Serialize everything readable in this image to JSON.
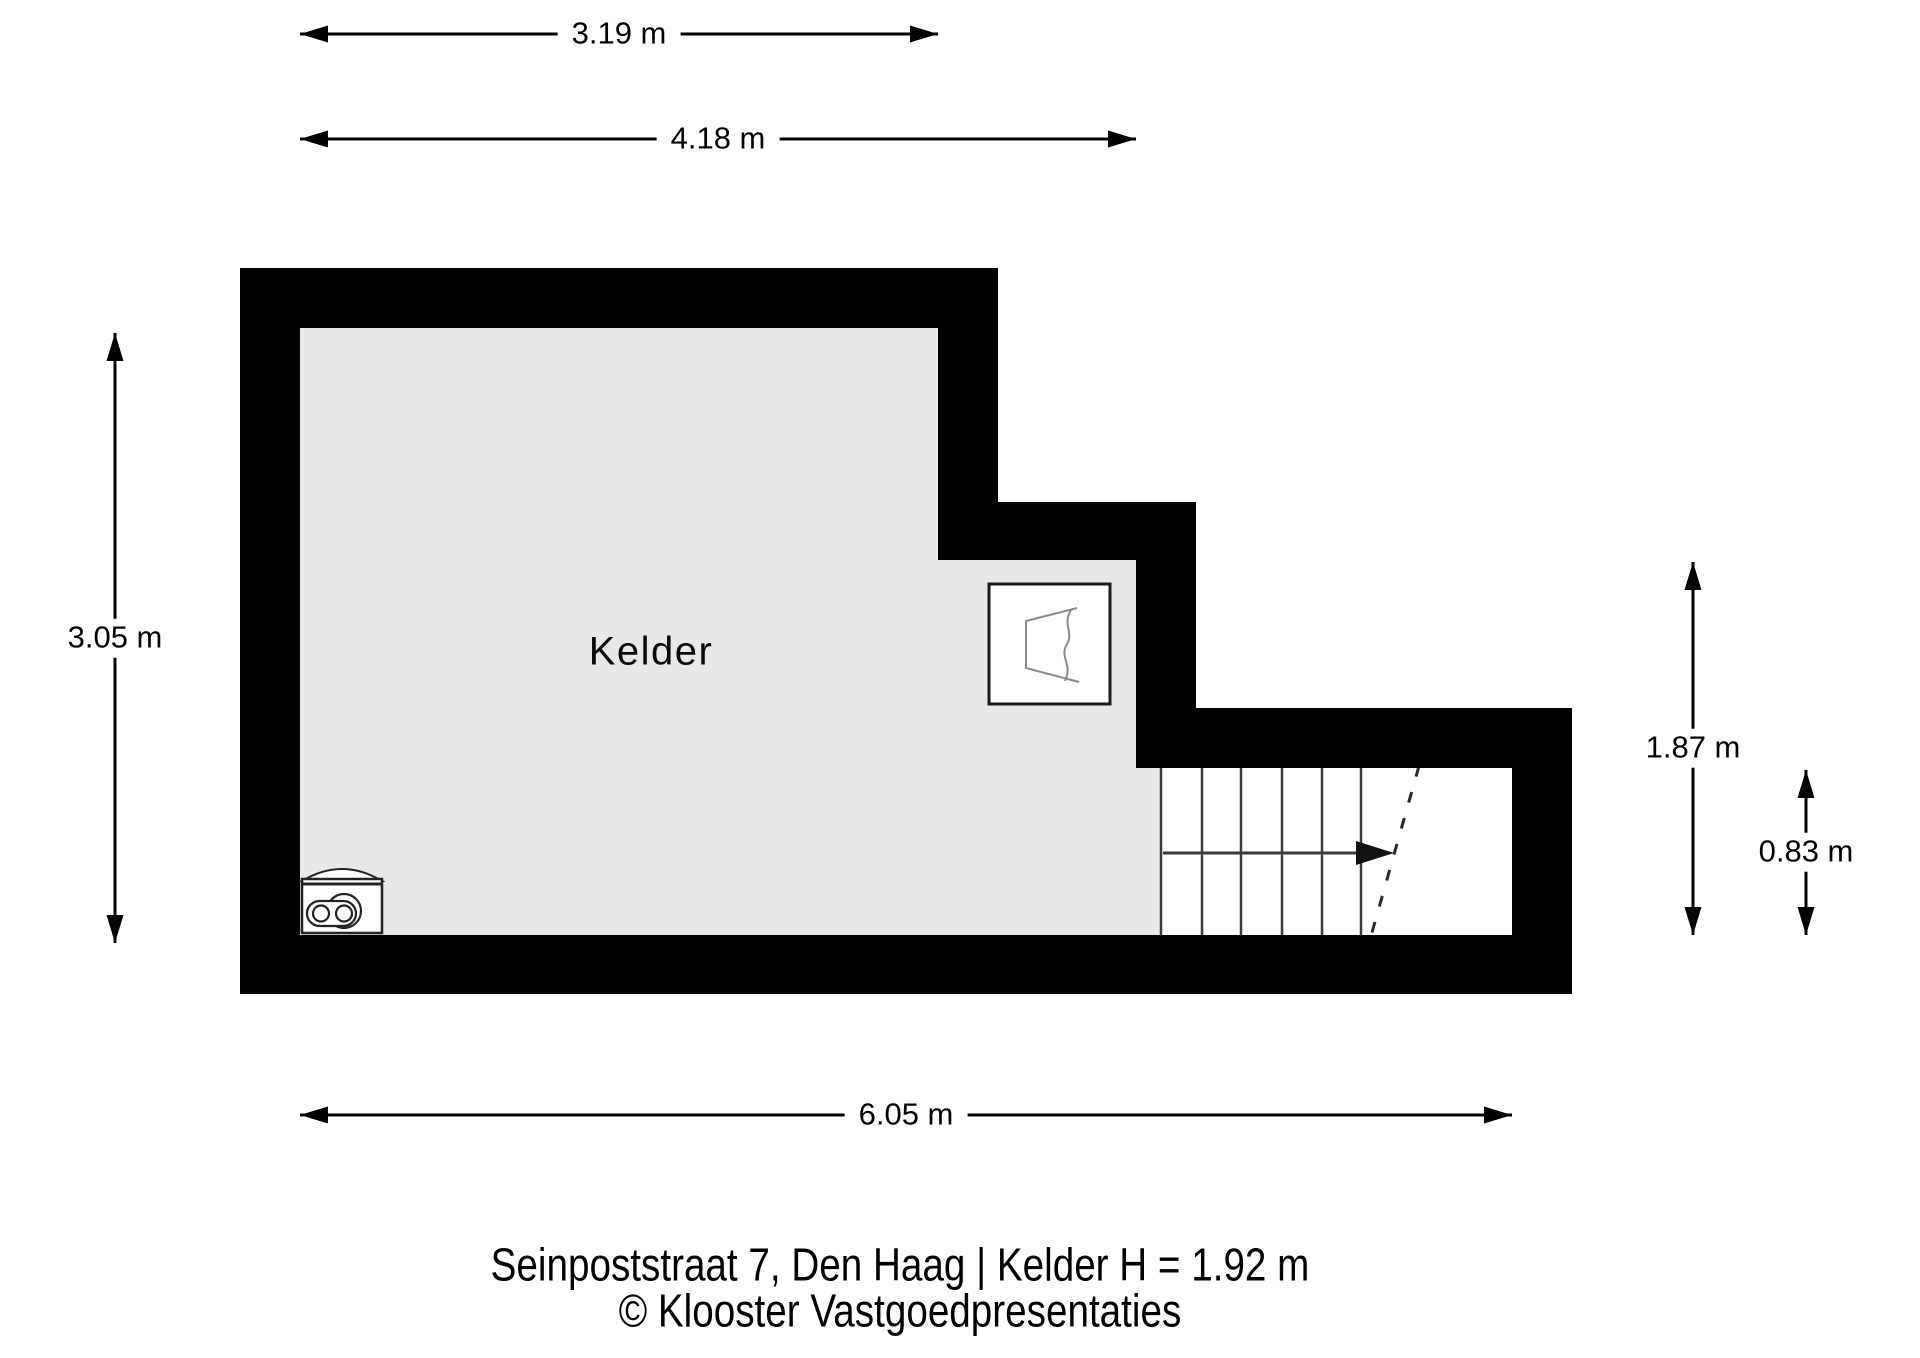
{
  "floorplan": {
    "room_label": "Kelder",
    "dimensions": {
      "top_partial": "3.19 m",
      "top_full": "4.18 m",
      "left_height": "3.05 m",
      "right_height": "1.87 m",
      "stairs_height": "0.83 m",
      "bottom_width": "6.05 m"
    },
    "colors": {
      "wall": "#000000",
      "room_fill": "#e8e8e8",
      "stairs_fill": "#ffffff",
      "dimension_line": "#000000",
      "symbol_stroke": "#8a8a8a",
      "background": "#ffffff"
    }
  },
  "caption": {
    "address": "Seinpoststraat 7, Den Haag | Kelder H = 1.92 m",
    "credit": "© Klooster Vastgoedpresentaties"
  }
}
